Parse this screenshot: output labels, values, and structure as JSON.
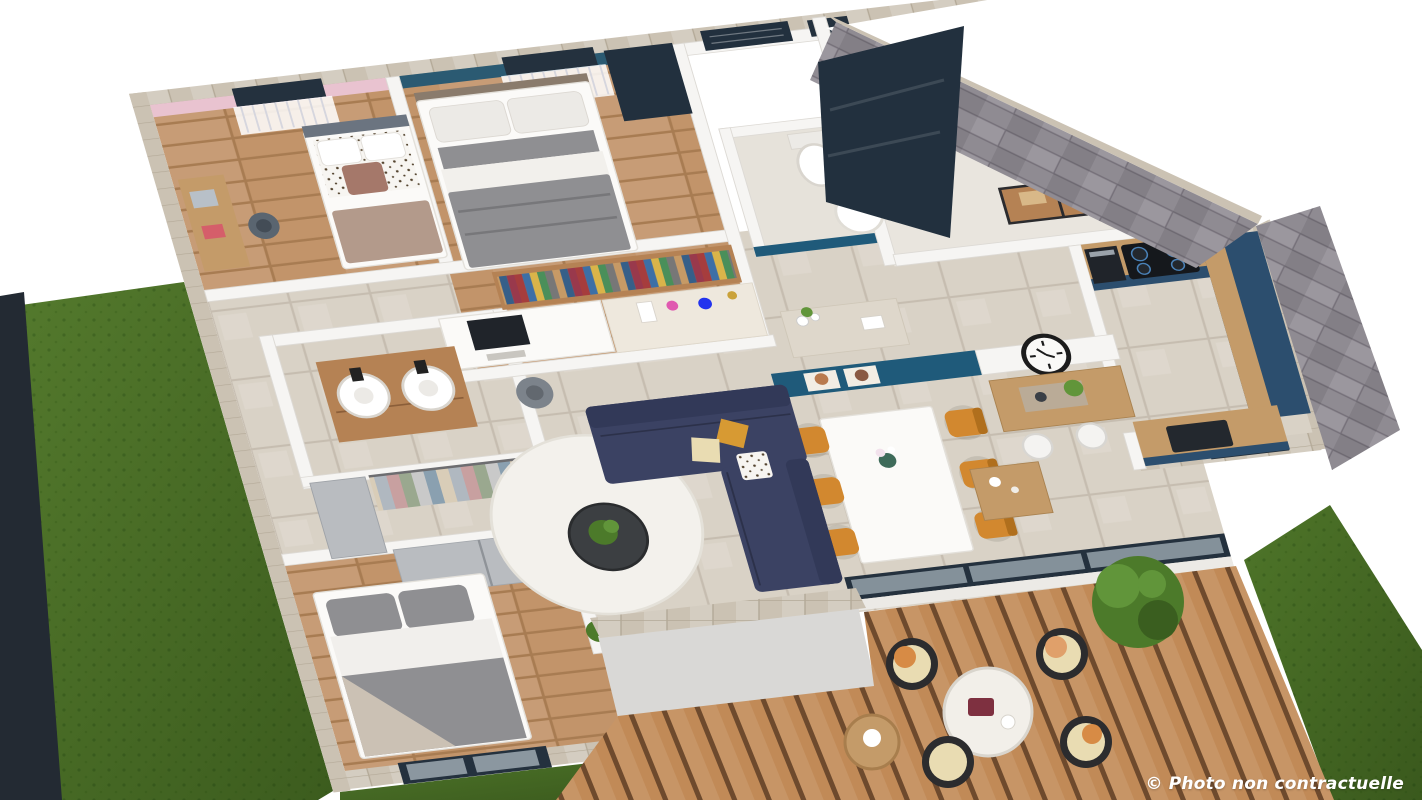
{
  "caption": "© Photo non contractuelle",
  "palette": {
    "background": "#ffffff",
    "fence": "#232a33",
    "lawn": "#547a2d",
    "lawn_dark": "#3c5c1e",
    "grass": "#4e7529",
    "grass_dark": "#3a591d",
    "deck_wood": "#c18a57",
    "deck_gap": "#6e4a2d",
    "tile": "#d9d2c6",
    "tile_line": "#c6bdb0",
    "wood": "#c2946a",
    "wood_dark": "#a87c52",
    "concrete": "#e9e5de",
    "wall_white": "#f6f5f3",
    "wall_line": "#dddad5",
    "cap": "#cbc2b3",
    "cap_line": "#b3a997",
    "stone": "#8f8b92",
    "stone_dark": "#7b767e",
    "stone_light": "#a39fa6",
    "pink_wall": "#e9c3d0",
    "teal_wall": "#2b5a72",
    "navy_wall": "#1f5a7a",
    "navy_door": "#22303e",
    "navy_kitchen": "#2c4e6e",
    "navy_sofa": "#3b4263",
    "navy_sofa_dark": "#323958",
    "orange": "#d2882f",
    "orange_dark": "#b06f1d",
    "wood_furniture": "#c49b69",
    "vanity_wood": "#b58254",
    "white_furniture": "#fbfaf8",
    "grey_soft": "#b9bcc0",
    "bed_grey": "#8f8f92",
    "bed_grey_dark": "#77777a",
    "blanket_taupe": "#b39a8b",
    "cushion_brown": "#a5786a",
    "cushion_mustard": "#d79a33",
    "cushion_cream": "#e9dcb2",
    "glass": "#aebac2",
    "frame_dark": "#24313e",
    "clock_black": "#1c1c1c",
    "plant_green": "#4c7a2a",
    "plant_light": "#61953a",
    "plant_dark": "#3a5e1f",
    "caption_color": "#ffffff"
  }
}
